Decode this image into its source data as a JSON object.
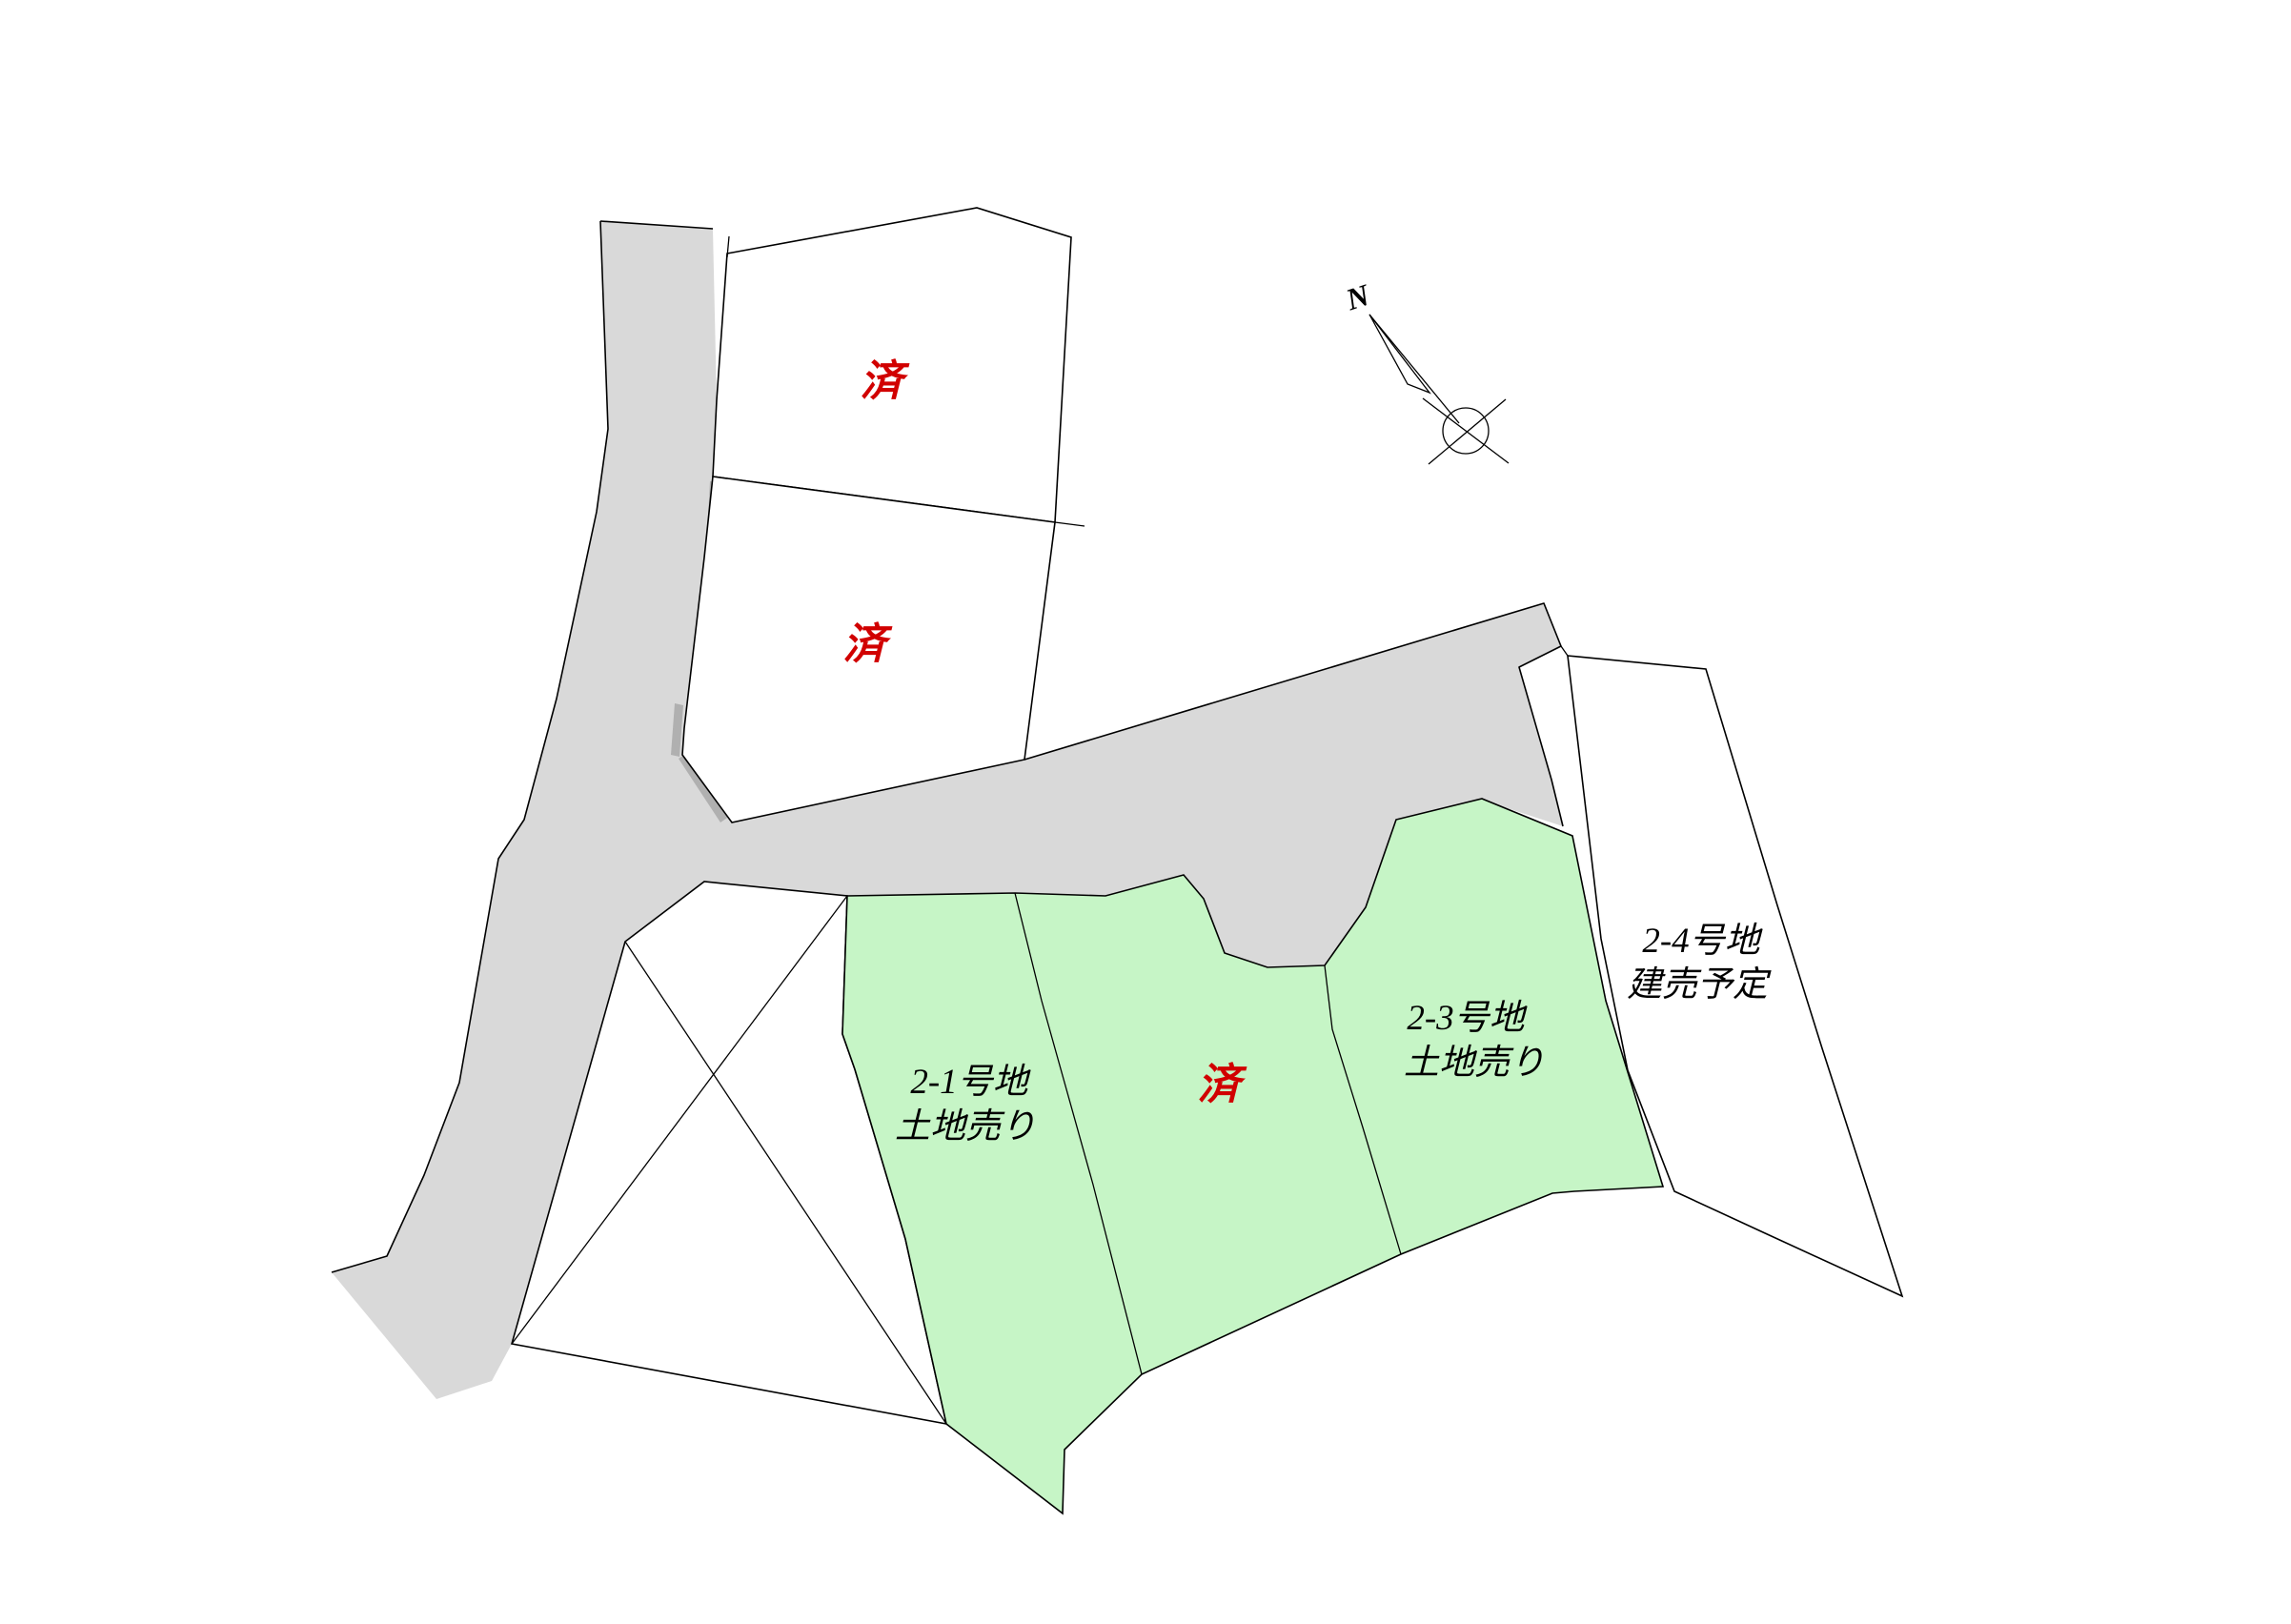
{
  "colors": {
    "background": "#FFFFFF",
    "road_fill": "#D9D9D9",
    "road_shadow": "#B0B0B0",
    "available_plot_fill": "#C6F5C6",
    "white_plot_fill": "#FFFFFF",
    "outline": "#000000",
    "sold_text": "#D10000",
    "label_text": "#000000"
  },
  "compass": {
    "north_label": "N"
  },
  "plots": {
    "sold_upper": {
      "status_label": "済"
    },
    "sold_lower": {
      "status_label": "済"
    },
    "lot_2_1": {
      "name": "2‐1号地",
      "status": "土地売り"
    },
    "sold_center": {
      "status_label": "済"
    },
    "lot_2_3": {
      "name": "2-3号地",
      "status": "土地売り"
    },
    "lot_2_4": {
      "name": "2‐4号地",
      "status": "建売予定"
    }
  }
}
